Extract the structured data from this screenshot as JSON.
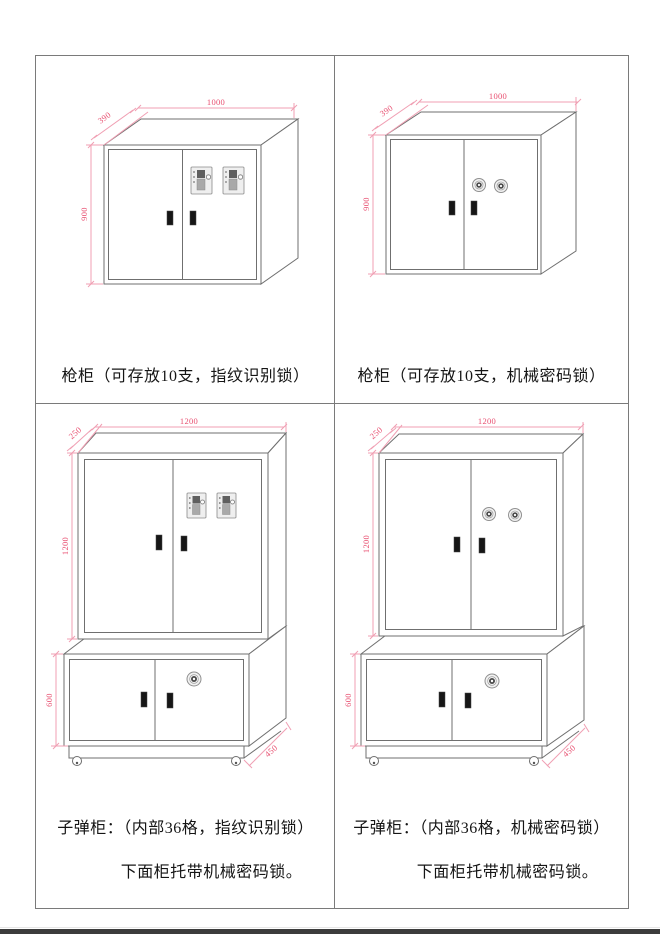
{
  "sheet": {
    "background": "#ffffff",
    "border_color": "#7a7a7a",
    "cabinet_outline_color": "#6f6f6f",
    "dimension_line_color": "#f09fb3",
    "dimension_text_color": "#e84f70"
  },
  "panels": [
    {
      "id": "gun-cabinet-fingerprint",
      "caption": "枪柜（可存放10支，指纹识别锁）",
      "lock_type": "fingerprint-lock",
      "dims": {
        "width": "1000",
        "depth": "390",
        "height": "900"
      }
    },
    {
      "id": "gun-cabinet-mechanical",
      "caption": "枪柜（可存放10支，机械密码锁）",
      "lock_type": "mechanical-dial-lock",
      "dims": {
        "width": "1000",
        "depth": "390",
        "height": "900"
      }
    },
    {
      "id": "ammo-cabinet-fingerprint",
      "caption": "子弹柜：（内部36格，指纹识别锁）",
      "caption2": "下面柜托带机械密码锁。",
      "lock_type": "fingerprint-lock",
      "dims": {
        "width": "1200",
        "depth": "250",
        "height": "1200",
        "base_height": "600",
        "base_depth": "450"
      }
    },
    {
      "id": "ammo-cabinet-mechanical",
      "caption": "子弹柜：（内部36格，机械密码锁）",
      "caption2": "下面柜托带机械密码锁。",
      "lock_type": "mechanical-dial-lock",
      "dims": {
        "width": "1200",
        "depth": "250",
        "height": "1200",
        "base_height": "600",
        "base_depth": "450"
      }
    }
  ]
}
